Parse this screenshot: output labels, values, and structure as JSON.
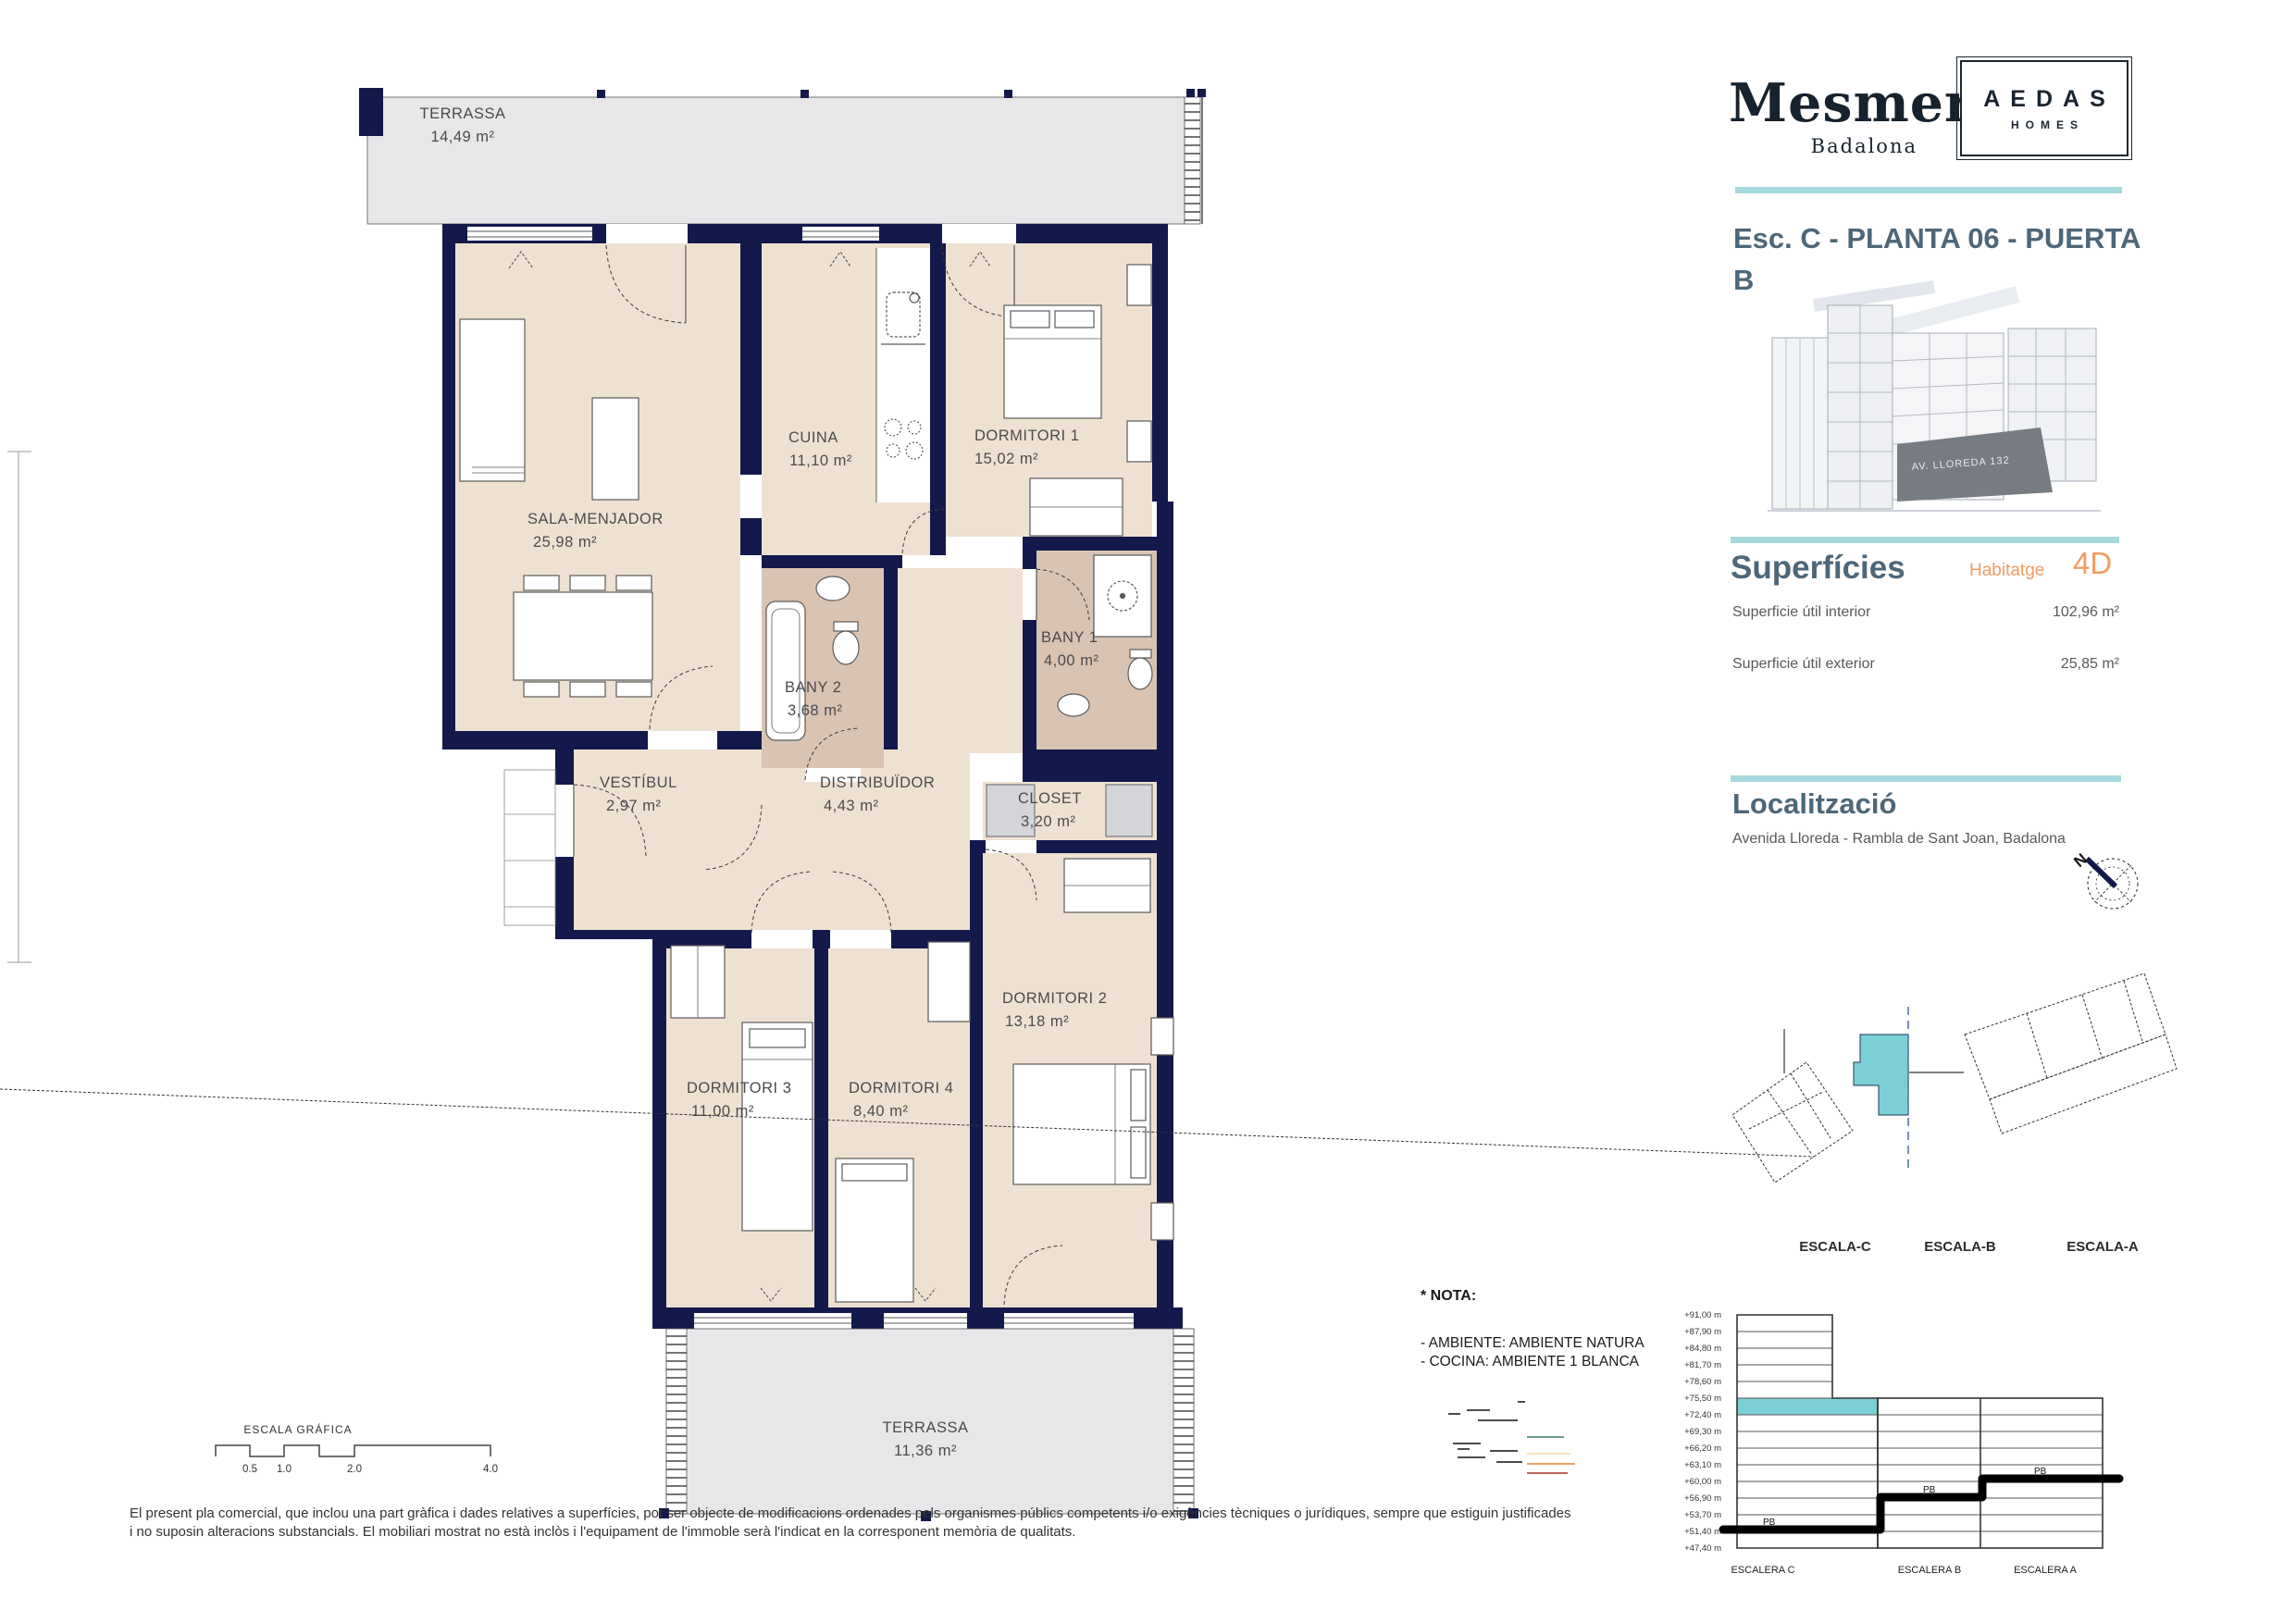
{
  "brand": {
    "name": "Mesmer",
    "city": "Badalona",
    "partner_line1": "AEDAS",
    "partner_line2": "HOMES"
  },
  "header": {
    "title": "Esc. C - PLANTA 06 - PUERTA B",
    "building_sign": "AV. LLOREDA 132"
  },
  "superficies": {
    "heading": "Superfícies",
    "unit_type_label": "Habitatge",
    "unit_type_value": "4D",
    "rows": [
      {
        "label": "Superficie útil interior",
        "value": "102,96 m²"
      },
      {
        "label": "Superficie útil exterior",
        "value": "25,85 m²"
      }
    ]
  },
  "localitzacio": {
    "heading": "Localització",
    "address": "Avenida Lloreda - Rambla de Sant Joan, Badalona",
    "compass_north_label": "N"
  },
  "site_plan": {
    "labels": [
      "ESCALA-C",
      "ESCALA-B",
      "ESCALA-A"
    ]
  },
  "nota": {
    "heading": "* NOTA:",
    "lines": [
      "- AMBIENTE: AMBIENTE NATURA",
      "- COCINA: AMBIENTE 1 BLANCA"
    ]
  },
  "elevation": {
    "heights": [
      "+91,00 m",
      "+87,90 m",
      "+84,80 m",
      "+81,70 m",
      "+78,60 m",
      "+75,50 m",
      "+72,40 m",
      "+69,30 m",
      "+66,20 m",
      "+63,10 m",
      "+60,00 m",
      "+56,90 m",
      "+53,70 m",
      "+51,40 m",
      "+47,40 m"
    ],
    "ground_label": "PB",
    "columns": [
      "ESCALERA C",
      "ESCALERA B",
      "ESCALERA A"
    ],
    "highlight_level": "+72,40 m"
  },
  "plan": {
    "rooms": {
      "terrassa_top": {
        "name": "TERRASSA",
        "area": "14,49 m²"
      },
      "sala": {
        "name": "SALA-MENJADOR",
        "area": "25,98 m²"
      },
      "cuina": {
        "name": "CUINA",
        "area": "11,10 m²"
      },
      "dormitori1": {
        "name": "DORMITORI 1",
        "area": "15,02 m²"
      },
      "bany1": {
        "name": "BANY 1",
        "area": "4,00 m²"
      },
      "bany2": {
        "name": "BANY 2",
        "area": "3,68 m²"
      },
      "vestibul": {
        "name": "VESTÍBUL",
        "area": "2,97 m²"
      },
      "distribuidor": {
        "name": "DISTRIBUÏDOR",
        "area": "4,43 m²"
      },
      "closet": {
        "name": "CLOSET",
        "area": "3,20 m²"
      },
      "dormitori2": {
        "name": "DORMITORI 2",
        "area": "13,18 m²"
      },
      "dormitori3": {
        "name": "DORMITORI 3",
        "area": "11,00 m²"
      },
      "dormitori4": {
        "name": "DORMITORI 4",
        "area": "8,40 m²"
      },
      "terrassa_bottom": {
        "name": "TERRASSA",
        "area": "11,36 m²"
      }
    }
  },
  "scale_bar": {
    "title": "ESCALA GRÁFICA",
    "ticks": [
      "0.5",
      "1.0",
      "2.0",
      "4.0"
    ]
  },
  "disclaimer": "El present pla comercial, que inclou una part gràfica i dades relatives a superfícies, pot ser objecte de modificacions ordenades pels organismes públics competents i/o exigències tècniques o jurídiques, sempre que estiguin justificades i no suposin alteracions substancials. El mobiliari mostrat no està inclòs i l'equipament de l'immoble serà l'indicat en la corresponent memòria de qualitats.",
  "colors": {
    "wall_navy": "#131a4b",
    "floor_beige": "#efe1d2",
    "bath_tan": "#d9c3b2",
    "terrace_gray": "#e7e7e9",
    "closet_gray": "#d4d5d8",
    "accent_teal": "#a6d9dd",
    "highlight_teal": "#7bd0d6",
    "accent_orange": "#f09c63",
    "heading_slate": "#4d6779"
  }
}
